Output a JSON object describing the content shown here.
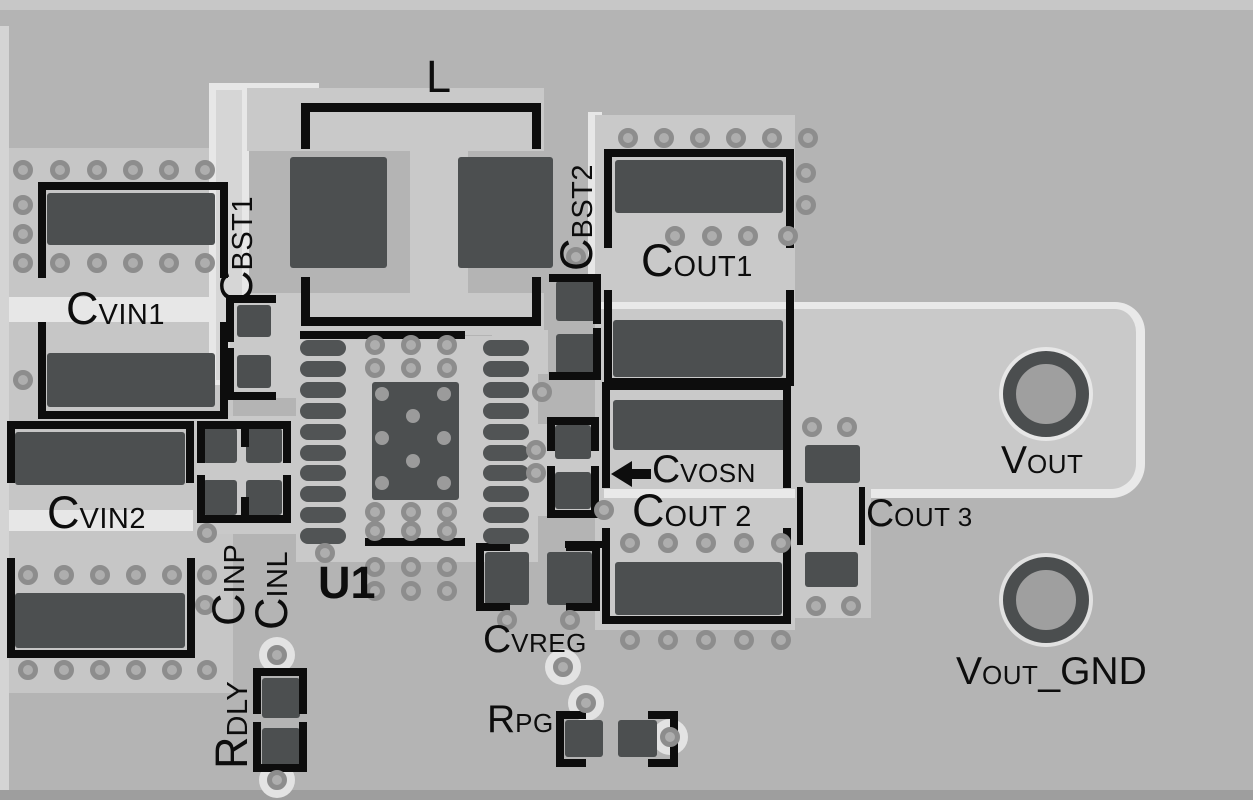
{
  "figure": {
    "kind": "pcb-layout-diagram"
  },
  "colors": {
    "background": "#b4b4b4",
    "copper_pour": "#c9c9c9",
    "trace_highlight": "#e7e7e7",
    "pad": "#4c4f50",
    "silkscreen": "#0d0d0d",
    "via_ring": "#8d8d8d"
  },
  "labels": {
    "l": {
      "main": "L"
    },
    "u1": {
      "main": "U1"
    },
    "cvin1": {
      "main": "C",
      "sub": "VIN1"
    },
    "cvin2": {
      "main": "C",
      "sub": "VIN2"
    },
    "cbst1": {
      "main": "C",
      "sub": "BST1"
    },
    "cbst2": {
      "main": "C",
      "sub": "BST2"
    },
    "cout1": {
      "main": "C",
      "sub": "OUT1"
    },
    "cout2": {
      "main": "C",
      "sub": "OUT 2"
    },
    "cout3": {
      "main": "C",
      "sub": "OUT 3"
    },
    "cvosn": {
      "main": "C",
      "sub": "VOSN"
    },
    "cinp": {
      "main": "C",
      "sub": "INP"
    },
    "cinl": {
      "main": "C",
      "sub": "INL"
    },
    "rdly": {
      "main": "R",
      "sub": "DLY"
    },
    "cvreg": {
      "main": "C",
      "sub": "VREG"
    },
    "rpg": {
      "main": "R",
      "sub": "PG"
    },
    "vout": {
      "main": "V",
      "sub": "OUT"
    },
    "vout_gnd": {
      "main": "V",
      "sub": "OUT",
      "tail": "_GND"
    }
  }
}
